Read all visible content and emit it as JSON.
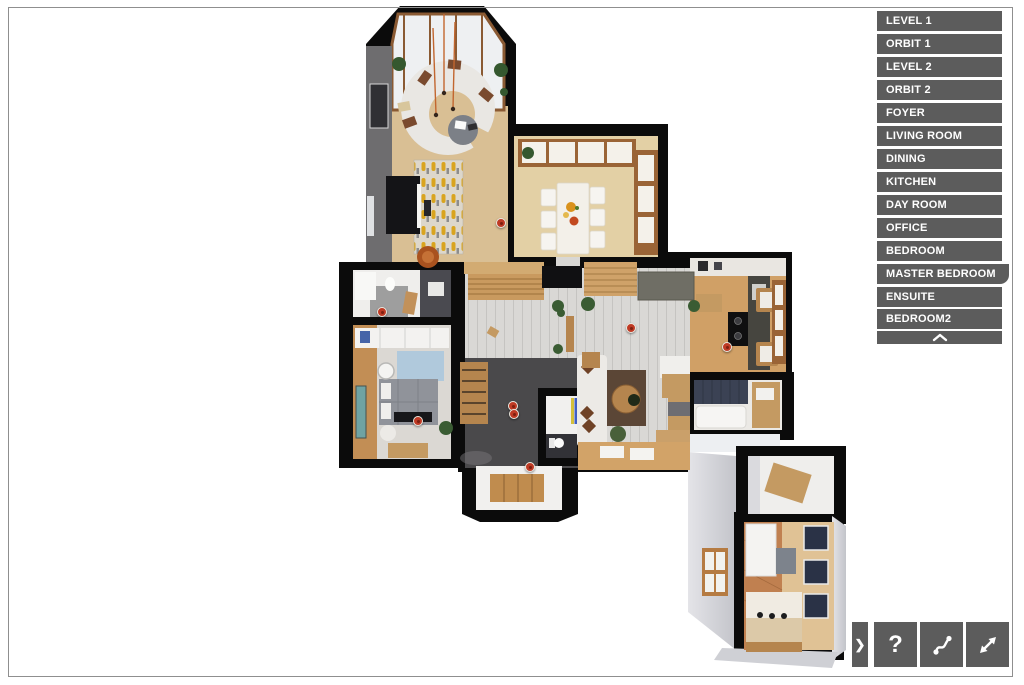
{
  "app": {
    "type": "3d-floorplan-viewer"
  },
  "colors": {
    "menu_button": "#5c5c5c",
    "menu_text": "#ffffff",
    "hotspot_red": "#bf3a24",
    "page_border": "#8f8f8f",
    "wall_black": "#0b0b0b"
  },
  "sidebar": {
    "items": [
      "LEVEL 1",
      "ORBIT 1",
      "LEVEL 2",
      "ORBIT 2",
      "FOYER",
      "LIVING ROOM",
      "DINING",
      "KITCHEN",
      "DAY ROOM",
      "OFFICE",
      "BEDROOM",
      "MASTER BEDROOM",
      "ENSUITE",
      "BEDROOM2"
    ],
    "scroll_up_icon": "chevron-up-icon"
  },
  "toolbar": {
    "collapse_glyph": "❯",
    "help_glyph": "?",
    "buttons": [
      {
        "name": "collapse-toolbar",
        "icon": "chevron-right-icon"
      },
      {
        "name": "help",
        "icon": "question-mark-icon"
      },
      {
        "name": "walkthrough-path",
        "icon": "path-icon"
      },
      {
        "name": "fullscreen",
        "icon": "expand-icon"
      }
    ]
  },
  "floorplan": {
    "hotspots": [
      [
        501,
        223
      ],
      [
        382,
        312
      ],
      [
        418,
        421
      ],
      [
        513,
        406
      ],
      [
        514,
        414
      ],
      [
        530,
        467
      ],
      [
        631,
        328
      ],
      [
        727,
        347
      ]
    ]
  }
}
